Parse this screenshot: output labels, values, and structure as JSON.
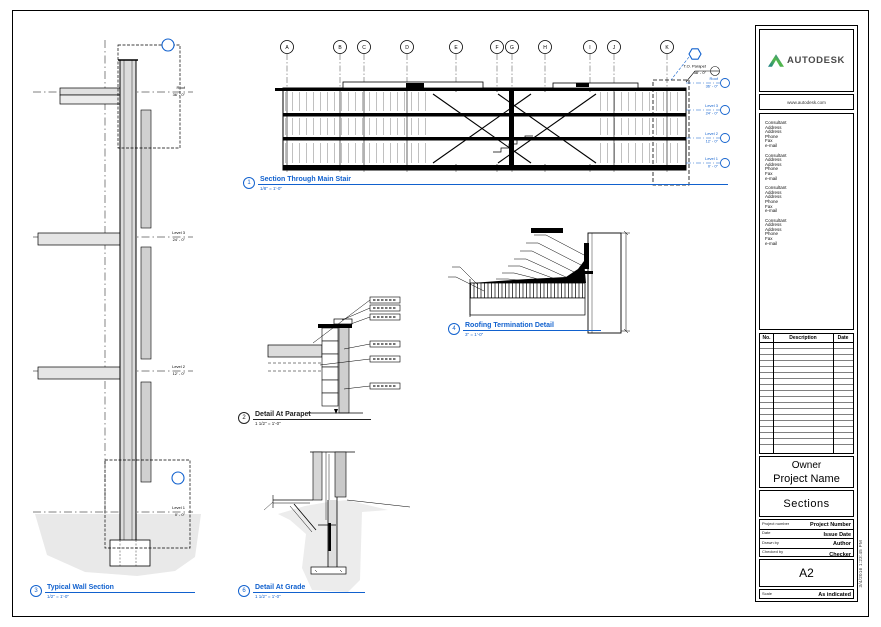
{
  "sheet": {
    "views": {
      "main_section": {
        "number": "1",
        "title": "Section Through Main Stair",
        "scale": "1/8\" = 1'-0\""
      },
      "wall_section": {
        "number": "3",
        "title": "Typical Wall Section",
        "scale": "1/2\" = 1'-0\""
      },
      "parapet_detail": {
        "number": "2",
        "title": "Detail At Parapet",
        "scale": "1 1/2\" = 1'-0\""
      },
      "roofing_detail": {
        "number": "4",
        "title": "Roofing Termination Detail",
        "scale": "3\" = 1'-0\""
      },
      "grade_detail": {
        "number": "6",
        "title": "Detail At Grade",
        "scale": "1 1/2\" = 1'-0\""
      }
    },
    "grids": [
      "A",
      "B",
      "C",
      "D",
      "E",
      "F",
      "G",
      "H",
      "I",
      "J",
      "K"
    ],
    "section_levels": [
      {
        "name": "T.O. Parapet",
        "elev": "38' - 0\""
      },
      {
        "name": "Roof",
        "elev": "36' - 0\""
      },
      {
        "name": "Level 3",
        "elev": "24' - 0\""
      },
      {
        "name": "Level 2",
        "elev": "12' - 0\""
      },
      {
        "name": "Level 1",
        "elev": "0' - 0\""
      }
    ],
    "wall_levels": [
      {
        "name": "Roof",
        "elev": "36' - 0\""
      },
      {
        "name": "Level 3",
        "elev": "24' - 0\""
      },
      {
        "name": "Level 2",
        "elev": "12' - 0\""
      },
      {
        "name": "Level 1",
        "elev": "0' - 0\""
      }
    ],
    "titleblock": {
      "logo_text": "AUTODESK",
      "website": "www.autodesk.com",
      "consultants": [
        "Consultant\nAddress\nAddress\nPhone\nFax\ne-mail",
        "Consultant\nAddress\nAddress\nPhone\nFax\ne-mail",
        "Consultant\nAddress\nAddress\nPhone\nFax\ne-mail",
        "Consultant\nAddress\nAddress\nPhone\nFax\ne-mail"
      ],
      "revision_headers": [
        "No.",
        "Description",
        "Date"
      ],
      "owner": "Owner",
      "project_name": "Project Name",
      "sheet_title": "Sections",
      "fields": [
        {
          "label": "Project number",
          "value": "Project Number"
        },
        {
          "label": "Date",
          "value": "Issue Date"
        },
        {
          "label": "Drawn by",
          "value": "Author"
        },
        {
          "label": "Checked by",
          "value": "Checker"
        }
      ],
      "sheet_number": "A2",
      "scale_label": "Scale",
      "scale_value": "As indicated",
      "print_stamp": "3/4/2016 1:23:45 PM"
    },
    "accent_blue": "#1161CE"
  }
}
